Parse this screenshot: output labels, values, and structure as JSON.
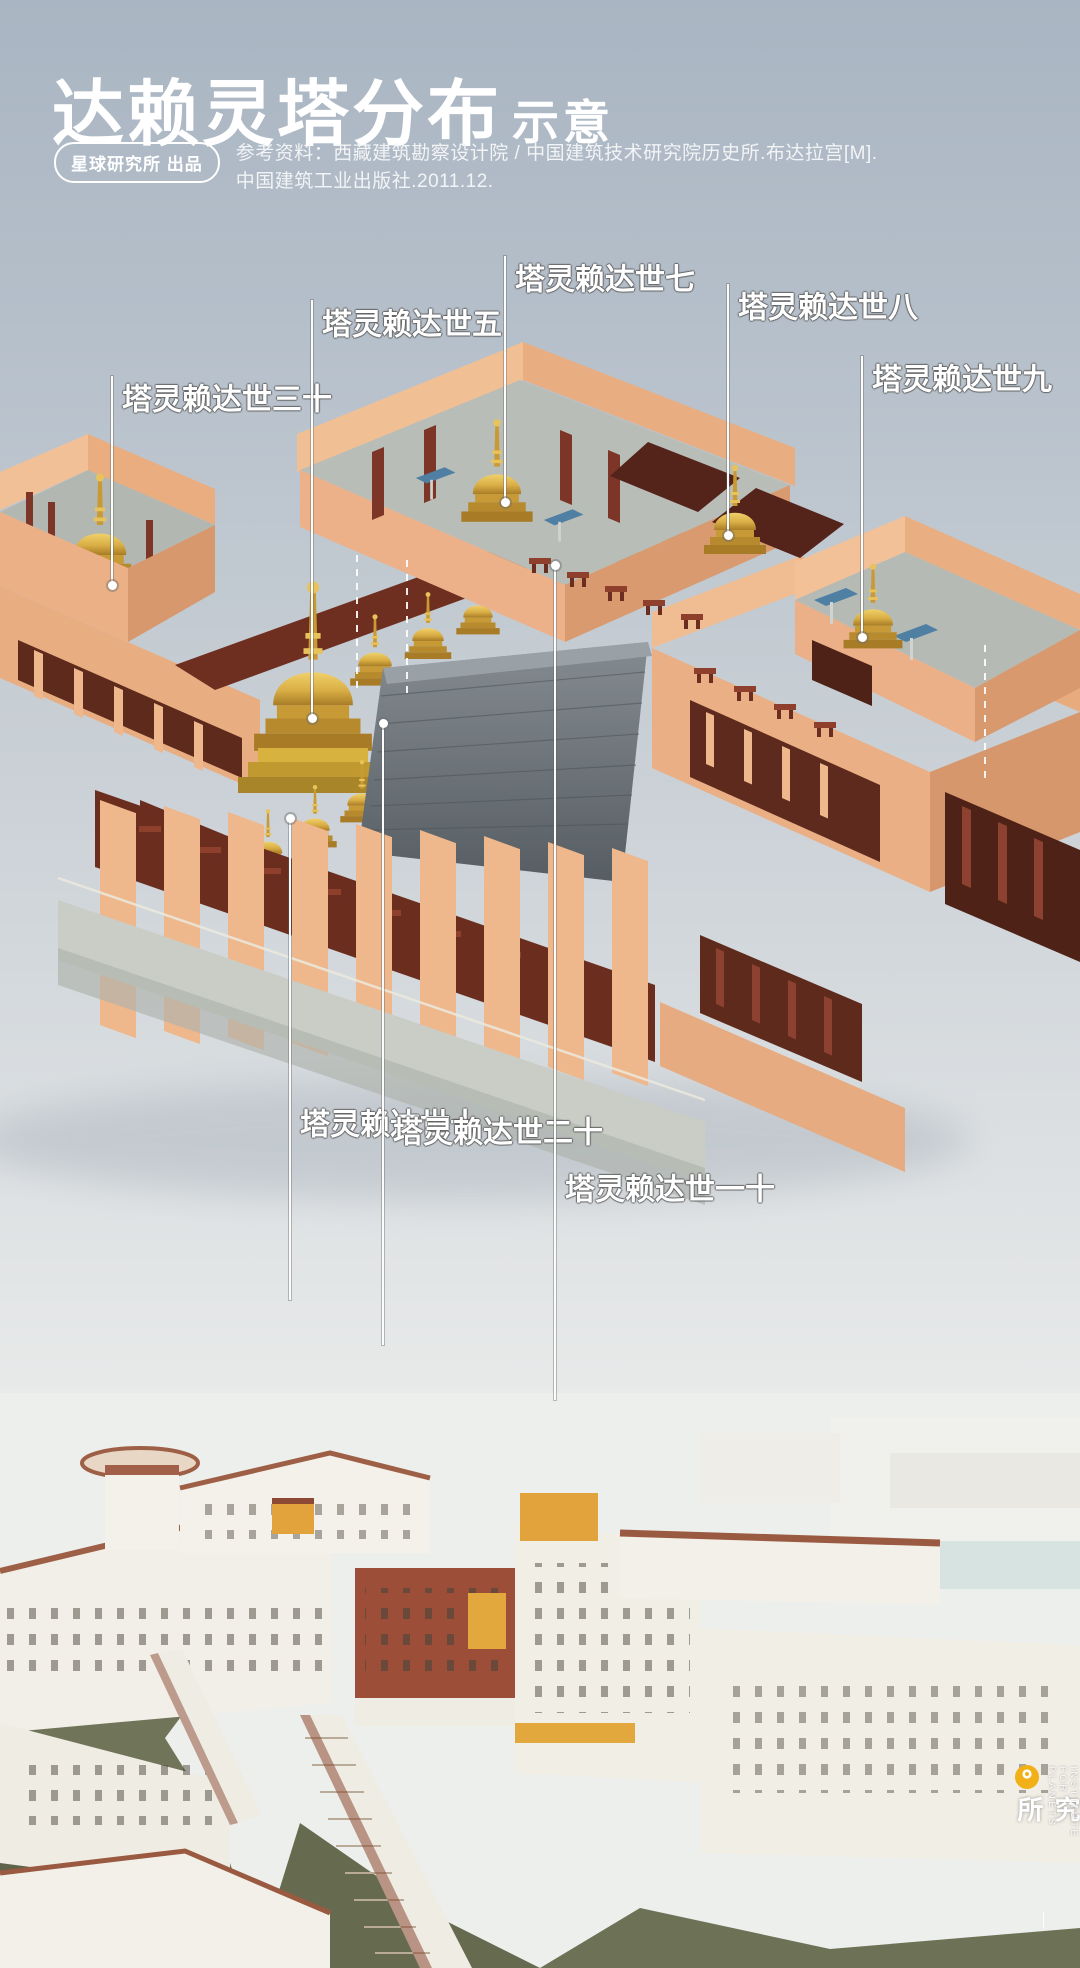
{
  "header": {
    "title_main": "达赖灵塔分布",
    "title_sub": "示意",
    "badge": "星球研究所 出品",
    "reference_line1": "参考资料：西藏建筑勘察设计院 / 中国建筑技术研究院历史所.布达拉宫[M].",
    "reference_line2": "中国建筑工业出版社.2011.12."
  },
  "diagram": {
    "labels": [
      {
        "id": "dalai-13",
        "text": "十三世达赖灵塔",
        "x": 112,
        "line_y1": 376,
        "line_y2": 585,
        "dot_y": 585,
        "text_y": 383
      },
      {
        "id": "dalai-5",
        "text": "五世达赖灵塔",
        "x": 312,
        "line_y1": 300,
        "line_y2": 718,
        "dot_y": 718,
        "text_y": 308
      },
      {
        "id": "dalai-7",
        "text": "七世达赖灵塔",
        "x": 505,
        "line_y1": 256,
        "line_y2": 502,
        "dot_y": 502,
        "text_y": 263
      },
      {
        "id": "dalai-8",
        "text": "八世达赖灵塔",
        "x": 728,
        "line_y1": 284,
        "line_y2": 535,
        "dot_y": 535,
        "text_y": 291
      },
      {
        "id": "dalai-9",
        "text": "九世达赖灵塔",
        "x": 862,
        "line_y1": 356,
        "line_y2": 637,
        "dot_y": 637,
        "text_y": 363
      },
      {
        "id": "dalai-10",
        "text": "十世达赖灵塔",
        "x": 290,
        "line_y1": 818,
        "line_y2": 1300,
        "dot_y": 818,
        "text_y": 1108
      },
      {
        "id": "dalai-12",
        "text": "十二世达赖灵塔",
        "x": 383,
        "line_y1": 723,
        "line_y2": 1345,
        "dot_y": 723,
        "text_y": 1116
      },
      {
        "id": "dalai-11",
        "text": "十一世达赖灵塔",
        "x": 555,
        "line_y1": 565,
        "line_y2": 1400,
        "dot_y": 565,
        "text_y": 1173
      }
    ]
  },
  "footer_logo": {
    "cn": "星球研究所",
    "en": "INSTITUTE FOR PLANETS",
    "accent": "#f2b018"
  },
  "colors": {
    "background_top": "#a9b5c2",
    "background_bottom": "#eff0ee",
    "wall_peach": "#f0bd93",
    "wall_peach_shade": "#d8996e",
    "inner_red": "#6f2f20",
    "stupa_gold": "#d9ae45",
    "roof_gray": "#6f767c",
    "palace_red": "#9d4e38",
    "palace_ochre": "#e2a73d",
    "hill_green": "#70755a",
    "logo_yellow": "#f2b018"
  }
}
